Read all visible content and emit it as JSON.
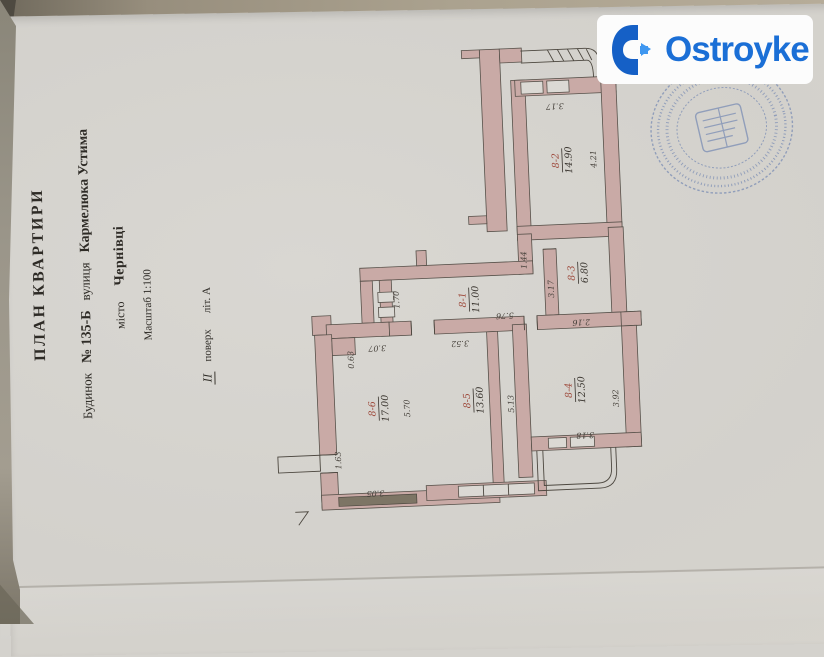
{
  "watermark": {
    "brand": "Ostroyke"
  },
  "title_block": {
    "title": "ПЛАН КВАРТИРИ",
    "building_label": "Будинок",
    "building_no": "№ 135-Б",
    "street_label": "вулиця",
    "street_name": "Кармелюка Устима",
    "city_label": "місто",
    "city_name": "Чернівці",
    "scale": "Масштаб 1:100",
    "floor_num": "ІІ",
    "floor_word": "поверх",
    "liter": "літ. А"
  },
  "plan": {
    "rooms": [
      {
        "id": "8-1",
        "area": "11.00"
      },
      {
        "id": "8-2",
        "area": "14.90"
      },
      {
        "id": "8-3",
        "area": "6.80"
      },
      {
        "id": "8-4",
        "area": "12.50"
      },
      {
        "id": "8-5",
        "area": "13.60"
      },
      {
        "id": "8-6",
        "area": "17.00"
      }
    ],
    "dims": [
      "3.17",
      "4.21",
      "3.17",
      "2.16",
      "1.44",
      "5.76",
      "1.70",
      "3.07",
      "0.63",
      "5.70",
      "1.63",
      "3.05",
      "3.52",
      "5.13",
      "3.92",
      "3.18"
    ]
  },
  "colors": {
    "wall_fill": "#c9aaa6",
    "line": "#57514a",
    "room_number_ink": "#9e4a3c",
    "stamp_ink": "#4f6ba8",
    "logo_blue": "#1b6fd6",
    "paper": "#d5d3ce"
  }
}
